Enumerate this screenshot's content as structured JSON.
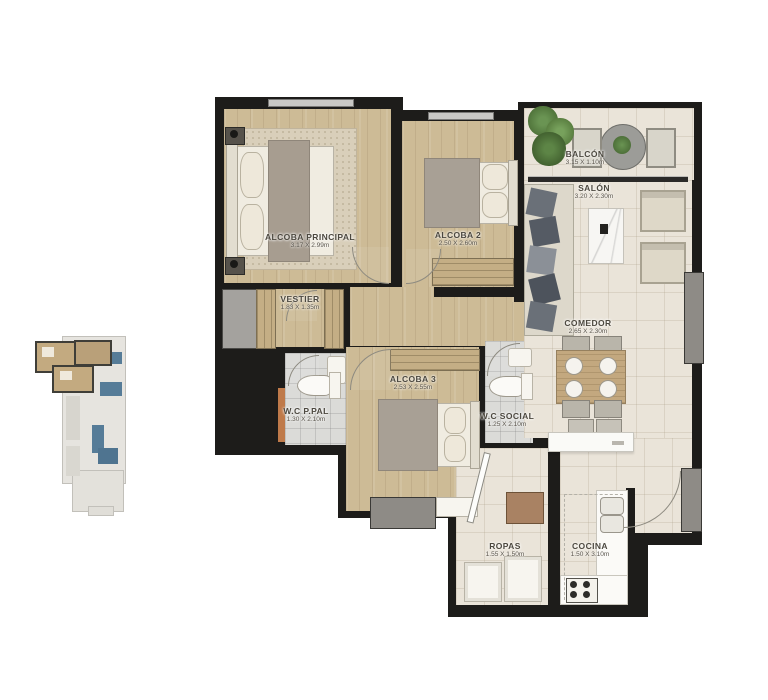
{
  "plan": {
    "title": "apartment-floor-plan",
    "rooms": [
      {
        "name": "ALCOBA PRINCIPAL",
        "dims": "3.17 X 2.99m"
      },
      {
        "name": "ALCOBA 2",
        "dims": "2.50 X 2.60m"
      },
      {
        "name": "BALCÓN",
        "dims": "3.15 X 1.10m"
      },
      {
        "name": "SALÓN",
        "dims": "3.20 X 2.30m"
      },
      {
        "name": "VESTIER",
        "dims": "1.83 X 1.35m"
      },
      {
        "name": "W.C P.PAL",
        "dims": "1.30 X 2.10m"
      },
      {
        "name": "ALCOBA 3",
        "dims": "2.53 X 2.55m"
      },
      {
        "name": "W.C SOCIAL",
        "dims": "1.25 X 2.10m"
      },
      {
        "name": "COMEDOR",
        "dims": "2.65 X 2.30m"
      },
      {
        "name": "ROPAS",
        "dims": "1.55 X 1.50m"
      },
      {
        "name": "COCINA",
        "dims": "1.50 X 3.10m"
      }
    ],
    "colors": {
      "wall": "#1d1c1a",
      "wood_floor": "#cdbb96",
      "tile_floor": "#eae4d9",
      "bath_floor": "#dbdbd8",
      "keyplan_highlight": "#c3aa80",
      "keyplan_accent_blue": "#567c98",
      "plant_green": "#57793f"
    }
  }
}
